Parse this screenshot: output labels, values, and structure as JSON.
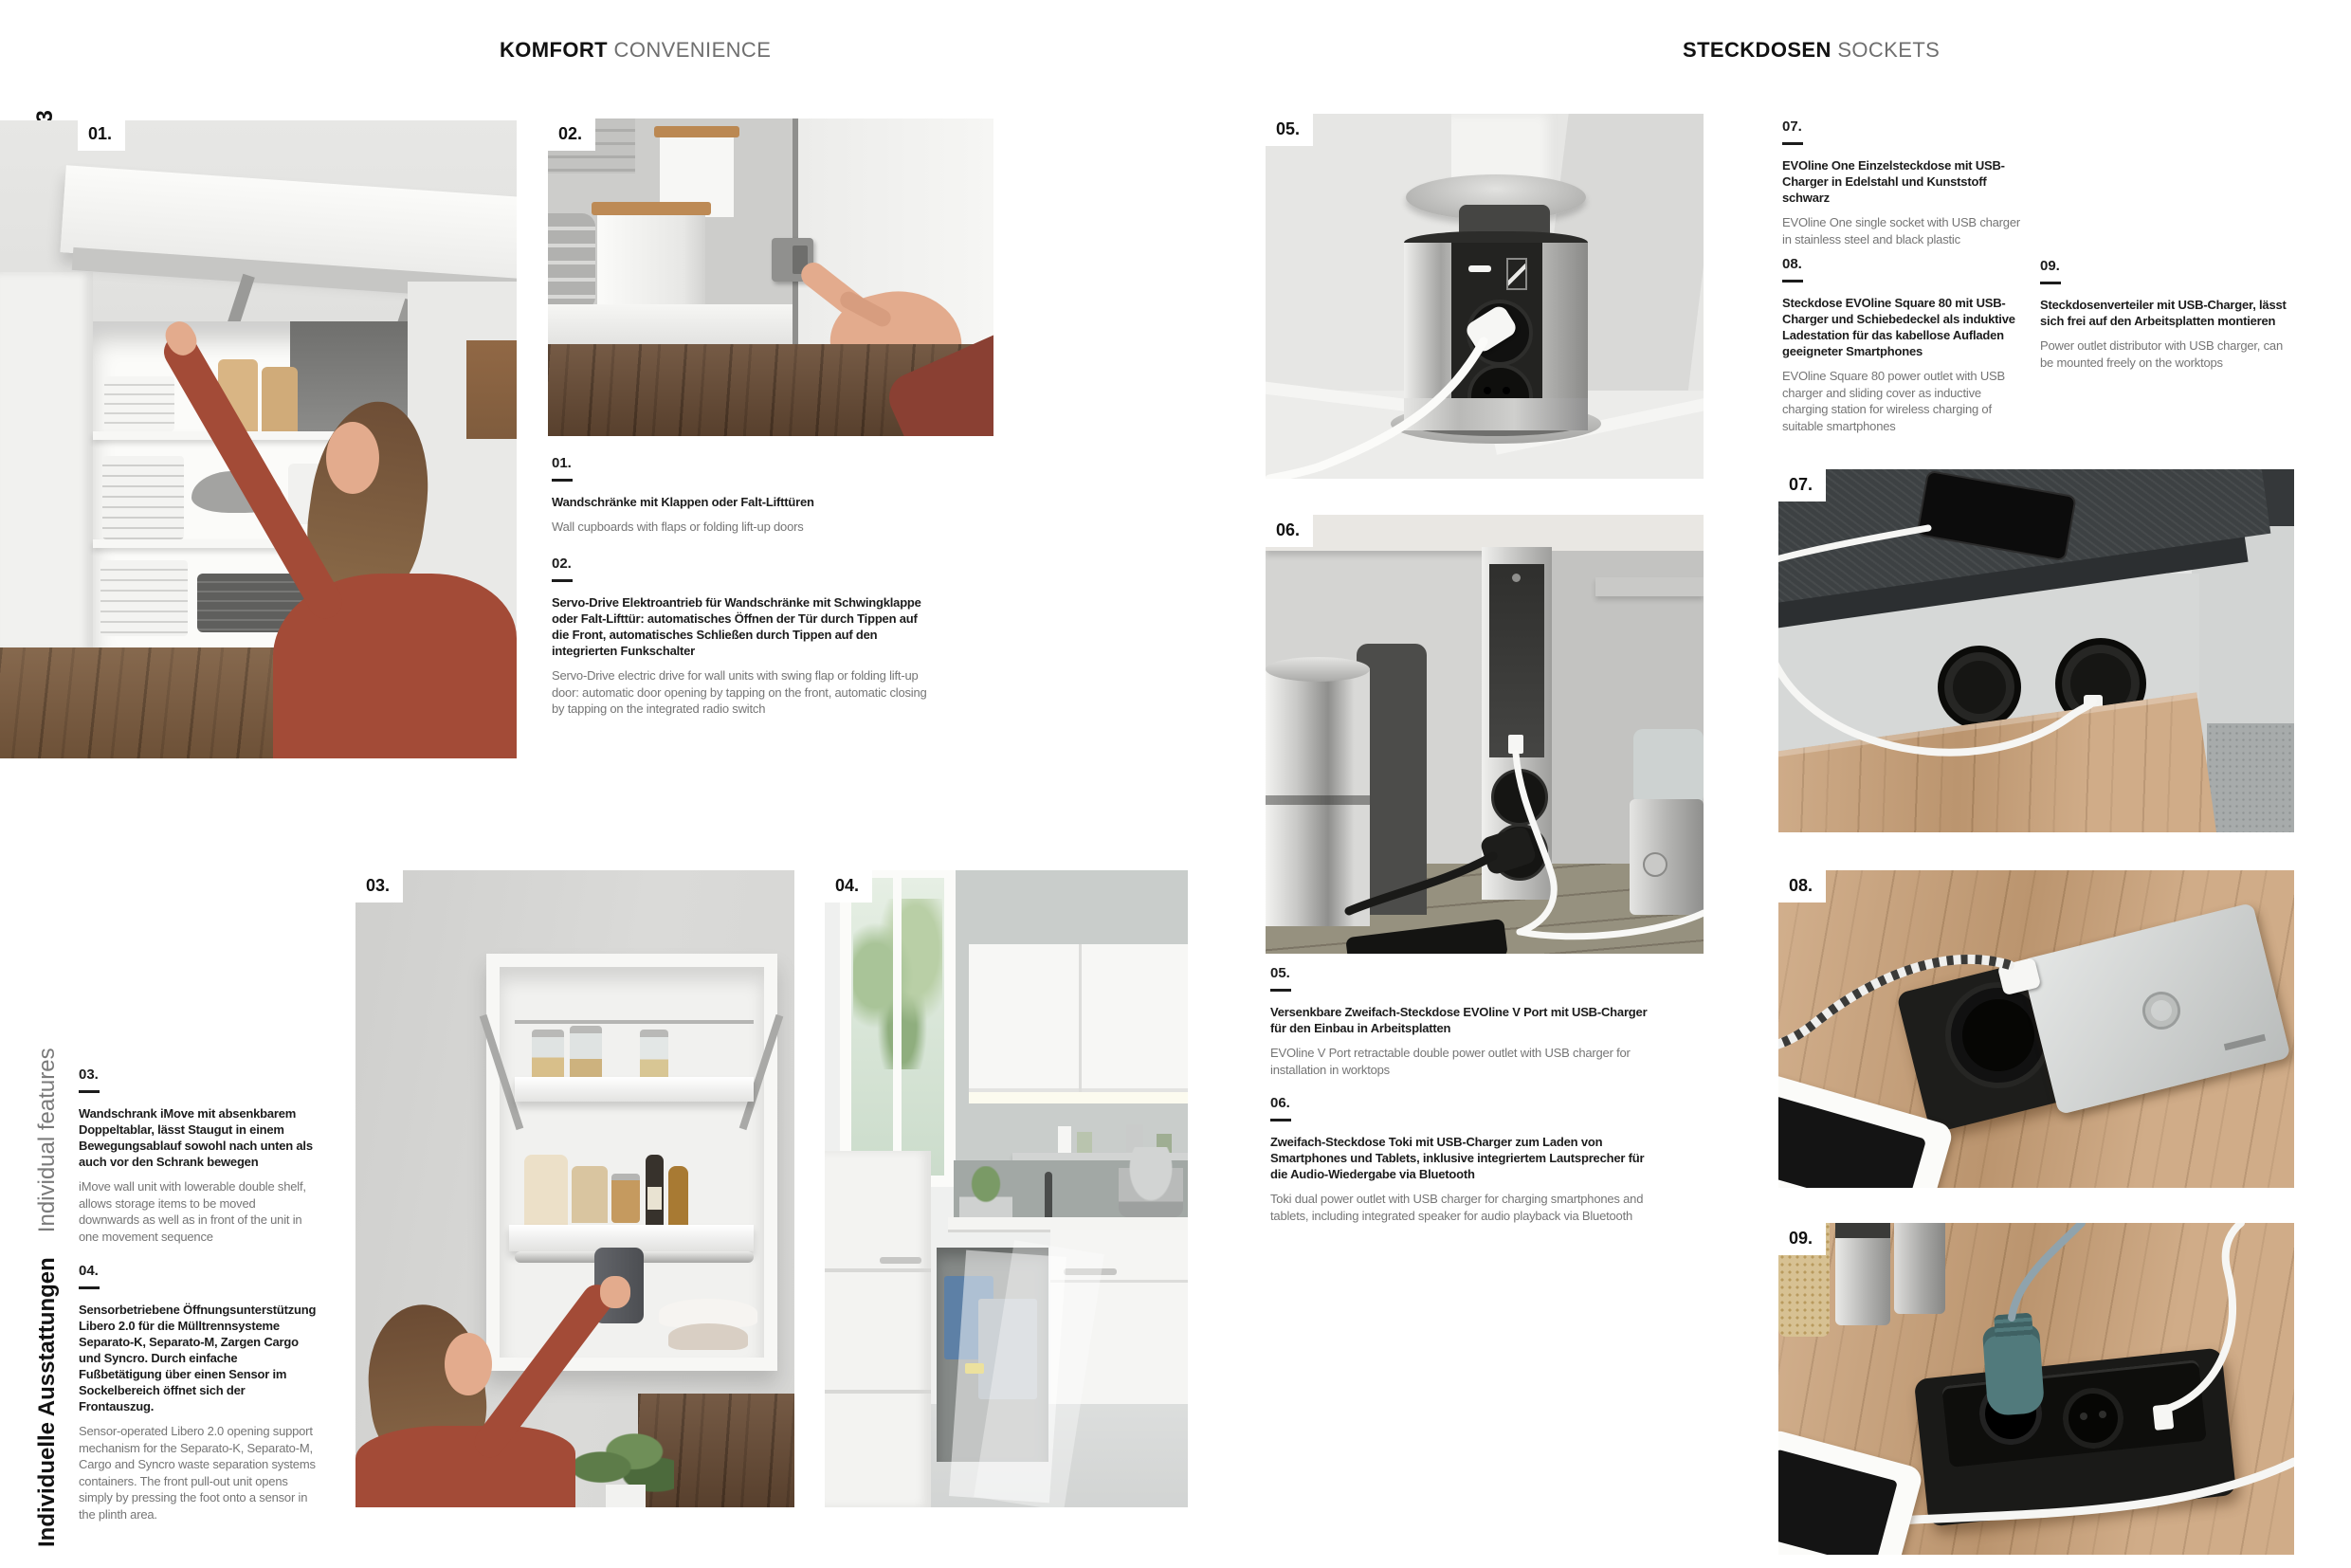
{
  "page": {
    "page_numbers": "172 • 173",
    "sidebar_vertical_de": "Individuelle Ausstattungen",
    "sidebar_vertical_en": "Individual features"
  },
  "headers": {
    "left_de": "KOMFORT",
    "left_en": "CONVENIENCE",
    "right_de": "STECKDOSEN",
    "right_en": "SOCKETS"
  },
  "captions": [
    {
      "number": "01.",
      "de": "Wandschränke mit Klappen oder Falt-Lifttüren",
      "en": "Wall cupboards with flaps or folding lift-up doors"
    },
    {
      "number": "02.",
      "de": "Servo-Drive Elektroantrieb für Wandschränke mit Schwingklappe oder Falt-Lifttür: automatisches Öffnen der Tür durch Tippen auf die Front, automatisches Schließen durch Tippen auf den integrierten Funkschalter",
      "en": "Servo-Drive electric drive for wall units with swing flap or folding lift-up door: automatic door opening by tapping on the front, automatic closing by tapping on the integrated radio switch"
    },
    {
      "number": "03.",
      "de": "Wandschrank iMove mit absenkbarem Doppeltablar, lässt Staugut in einem Bewegungsablauf sowohl nach unten als auch vor den Schrank bewegen",
      "en": "iMove wall unit with lowerable double shelf, allows storage items to be moved downwards as well as in front of the unit in one movement sequence"
    },
    {
      "number": "04.",
      "de": "Sensorbetriebene Öffnungsunterstützung Libero 2.0 für die Mülltrennsysteme Separato-K, Separato-M, Zargen Cargo und Syncro. Durch einfache Fußbetätigung über einen Sensor im Sockelbereich öffnet sich der Frontauszug.",
      "en": "Sensor-operated Libero 2.0 opening support mechanism for the Separato-K, Separato-M, Cargo and Syncro waste separation systems containers. The front pull-out unit opens simply by pressing the foot onto a sensor in the plinth area."
    },
    {
      "number": "05.",
      "de": "Versenkbare Zweifach-Steckdose EVOline V Port mit USB-Charger für den Einbau in Arbeitsplatten",
      "en": "EVOline V Port retractable double power outlet with USB charger for installation in worktops"
    },
    {
      "number": "06.",
      "de": "Zweifach-Steckdose Toki mit USB-Charger zum Laden von Smartphones und Tablets, inklusive integriertem Lautsprecher für die Audio-Wiedergabe via Bluetooth",
      "en": "Toki dual power outlet with USB charger for charging smartphones and tablets, including integrated speaker for audio playback via Bluetooth"
    },
    {
      "number": "07.",
      "de": "EVOline One Einzelsteckdose mit USB-Charger in Edelstahl und Kunststoff schwarz",
      "en": "EVOline One single socket with USB charger in stainless steel and black plastic"
    },
    {
      "number": "08.",
      "de": "Steckdose EVOline Square 80 mit USB-Charger und Schiebedeckel als induktive Ladestation für das kabellose Aufladen geeigneter Smartphones",
      "en": "EVOline Square 80 power outlet with USB charger and sliding cover as inductive charging station for wireless charging of suitable smartphones"
    },
    {
      "number": "09.",
      "de": "Steckdosenverteiler mit USB-Charger, lässt sich frei auf den Arbeitsplatten montieren",
      "en": "Power outlet distributor with USB charger, can be mounted freely on the worktops"
    }
  ],
  "colors": {
    "text_black": "#1c1c1c",
    "text_gray": "#757575",
    "wood_light": "#c9a077",
    "wood_dark": "#6b4e37",
    "slate_worktop": "#3d4143",
    "stainless": "#c9c9c7",
    "sweater_rust": "#a34b37",
    "plug_teal": "#517a7c"
  }
}
